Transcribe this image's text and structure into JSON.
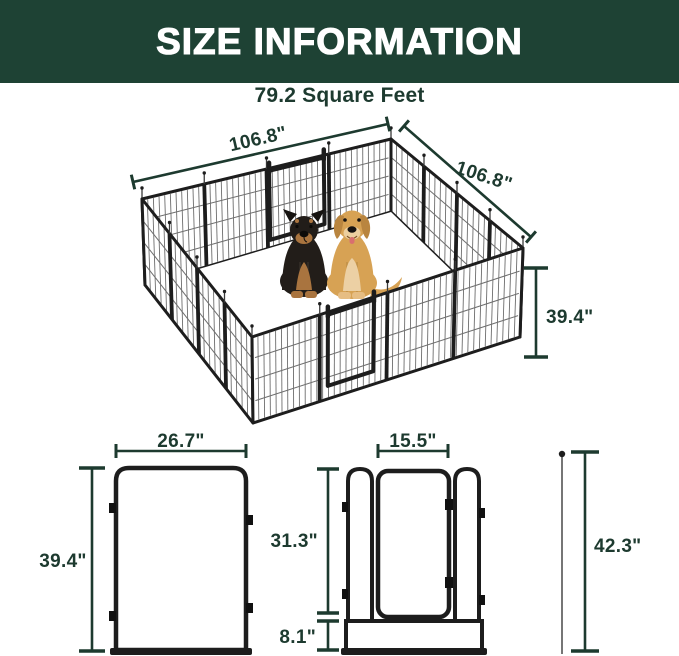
{
  "header": {
    "title": "SIZE INFORMATION"
  },
  "subtitle": "79.2 Square Feet",
  "colors": {
    "header_bg": "#1e4234",
    "accent_text": "#1d3a2f",
    "frame_black": "#1d1d1d",
    "grid_gray": "#6e6e6e",
    "rottweiler_coat": "#221d19",
    "rottweiler_tan": "#a9743f",
    "golden_coat": "#d7a254",
    "golden_light": "#ecd0a4"
  },
  "pen": {
    "width_left": "106.8\"",
    "width_right": "106.8\"",
    "height": "39.4\""
  },
  "panel": {
    "width": "26.7\"",
    "height": "39.4\""
  },
  "door_panel": {
    "door_width": "15.5\"",
    "door_height": "31.3\"",
    "bottom_height": "8.1\"",
    "total_height": "42.3\""
  }
}
